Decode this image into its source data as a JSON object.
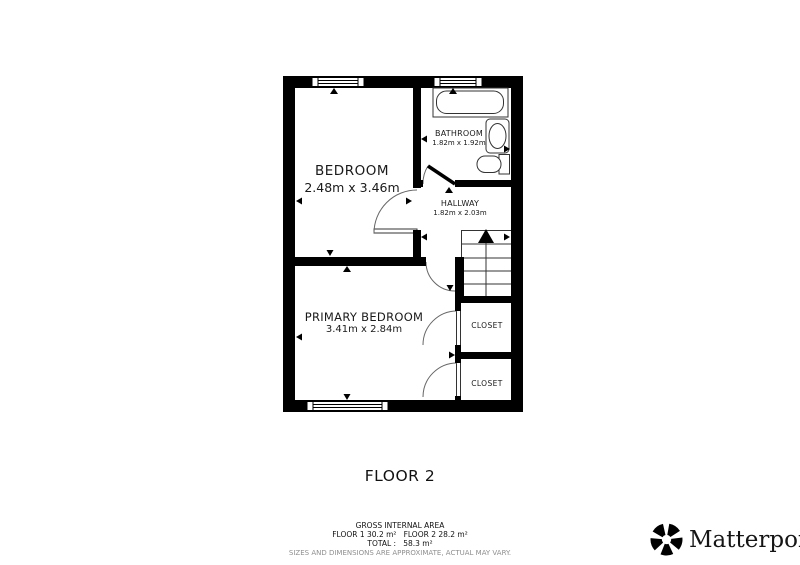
{
  "plan": {
    "floor_label": "FLOOR 2",
    "rooms": {
      "bedroom": {
        "name": "BEDROOM",
        "dims": "2.48m x 3.46m"
      },
      "bathroom": {
        "name": "BATHROOM",
        "dims": "1.82m x 1.92m"
      },
      "hallway": {
        "name": "HALLWAY",
        "dims": "1.82m x 2.03m"
      },
      "primary_bedroom": {
        "name": "PRIMARY BEDROOM",
        "dims": "3.41m x 2.84m"
      },
      "closet_1": {
        "name": "CLOSET"
      },
      "closet_2": {
        "name": "CLOSET"
      }
    },
    "features": {
      "windows": 3,
      "doors": 5,
      "stairs_direction": "up",
      "bathroom_fixtures": [
        "bathtub",
        "sink",
        "toilet"
      ]
    }
  },
  "footer": {
    "title": "GROSS INTERNAL AREA",
    "floors": "FLOOR 1 30.2 m²   FLOOR 2 28.2 m²",
    "total": "TOTAL :   58.3 m²",
    "disclaimer": "SIZES AND DIMENSIONS ARE APPROXIMATE, ACTUAL MAY VARY."
  },
  "branding": {
    "name": "Matterport",
    "registered": "®"
  },
  "colors": {
    "wall": "#000000",
    "thin_line": "#333333",
    "arc_line": "#666666",
    "disclaimer_text": "#8f8f8f",
    "background": "#ffffff"
  }
}
